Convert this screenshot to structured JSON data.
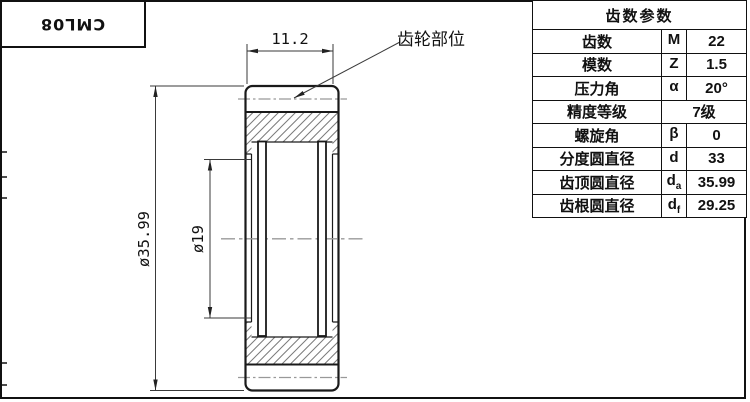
{
  "title_block": {
    "part_number": "CML08"
  },
  "drawing": {
    "dim_width": "11.2",
    "dim_outer_diameter": "ø35.99",
    "dim_bore_diameter": "ø19",
    "leader_label": "齿轮部位"
  },
  "table": {
    "header": "齿数参数",
    "rows": [
      {
        "label": "齿数",
        "symbol": {
          "base": "M",
          "sub": ""
        },
        "value": "22"
      },
      {
        "label": "模数",
        "symbol": {
          "base": "Z",
          "sub": ""
        },
        "value": "1.5"
      },
      {
        "label": "压力角",
        "symbol": {
          "base": "α",
          "sub": ""
        },
        "value": "20°"
      },
      {
        "label": "精度等级",
        "symbol": {
          "base": "",
          "sub": ""
        },
        "value": "7级"
      },
      {
        "label": "螺旋角",
        "symbol": {
          "base": "β",
          "sub": ""
        },
        "value": "0"
      },
      {
        "label": "分度圆直径",
        "symbol": {
          "base": "d",
          "sub": ""
        },
        "value": "33"
      },
      {
        "label": "齿顶圆直径",
        "symbol": {
          "base": "d",
          "sub": "a"
        },
        "value": "35.99"
      },
      {
        "label": "齿根圆直径",
        "symbol": {
          "base": "d",
          "sub": "f"
        },
        "value": "29.25"
      }
    ]
  },
  "colors": {
    "line": "#1a1a1a",
    "hatch": "#7a7a7a",
    "centerline": "#999999",
    "dimension": "#3a3a3a"
  }
}
